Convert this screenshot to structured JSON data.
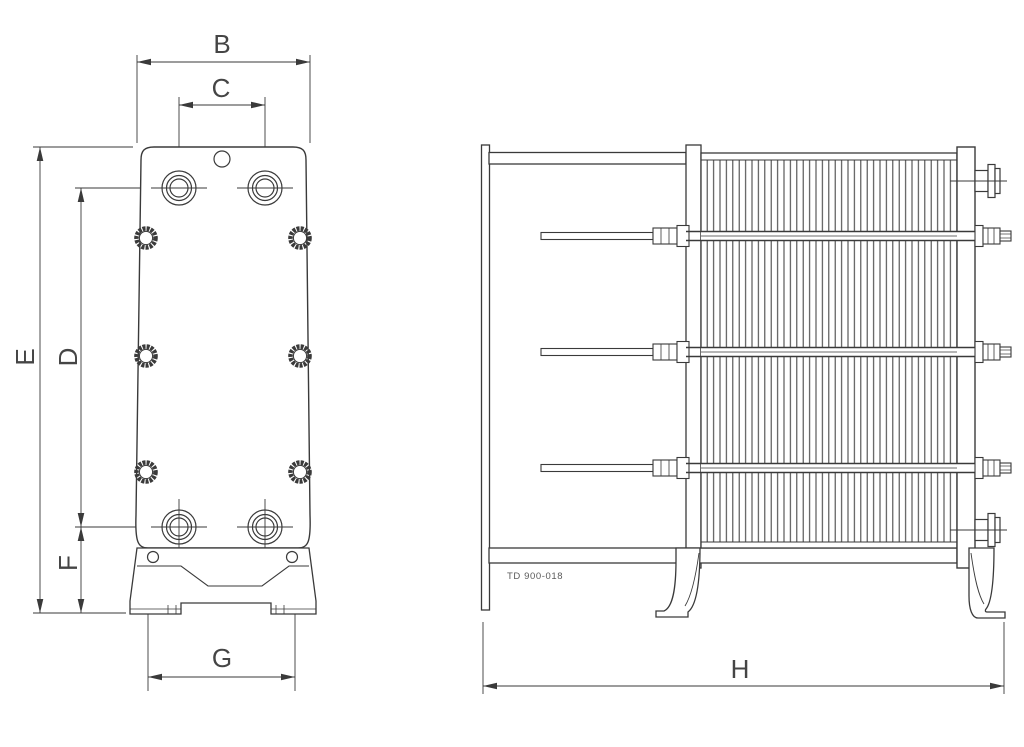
{
  "diagram": {
    "type": "technical-drawing",
    "subject": "plate-heat-exchanger-dimension-drawing",
    "background_color": "#ffffff",
    "line_color": "#3a3a3a",
    "label_color": "#454545",
    "drawing_number": "TD 900-018",
    "views": {
      "front_view": {
        "dimension_labels": [
          "B",
          "C",
          "D",
          "E",
          "F",
          "G"
        ]
      },
      "side_view": {
        "dimension_labels": [
          "H"
        ]
      }
    },
    "labels": {
      "B": "B",
      "C": "C",
      "D": "D",
      "E": "E",
      "F": "F",
      "G": "G",
      "H": "H"
    }
  }
}
